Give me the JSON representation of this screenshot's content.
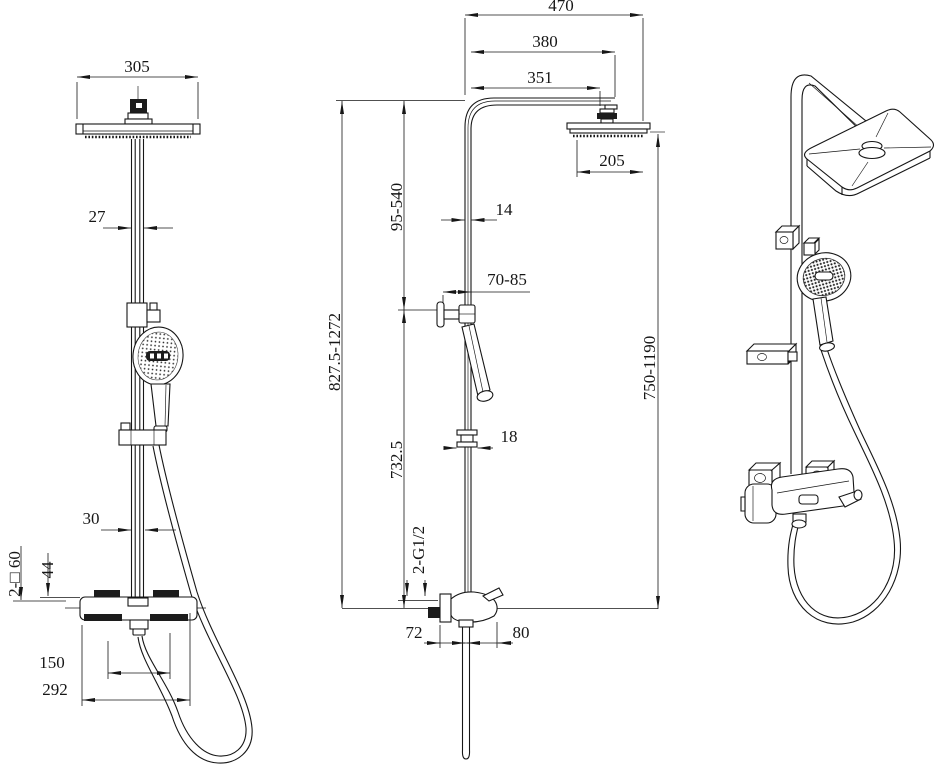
{
  "drawing": {
    "background": "#ffffff",
    "line_color": "#161616",
    "views": {
      "front": {
        "dims": {
          "head_width": "305",
          "pipe_width": "27",
          "riser_width": "30",
          "valve_body_height": "44",
          "escutcheons": "2-□ 60",
          "inlet_spacing": "150",
          "valve_width": "292"
        }
      },
      "side": {
        "dims": {
          "overall_reach": "470",
          "arm_reach": "380",
          "arm_length": "351",
          "head_depth": "205",
          "upper_riser_range": "95-540",
          "riser_depth": "14",
          "holder_reach": "70-85",
          "overall_height": "827.5-1272",
          "head_height": "750-1190",
          "lower_riser": "732.5",
          "slider_depth": "18",
          "connection_threads": "2-G1/2",
          "wall_to_riser": "72",
          "riser_to_front": "80"
        }
      }
    }
  }
}
